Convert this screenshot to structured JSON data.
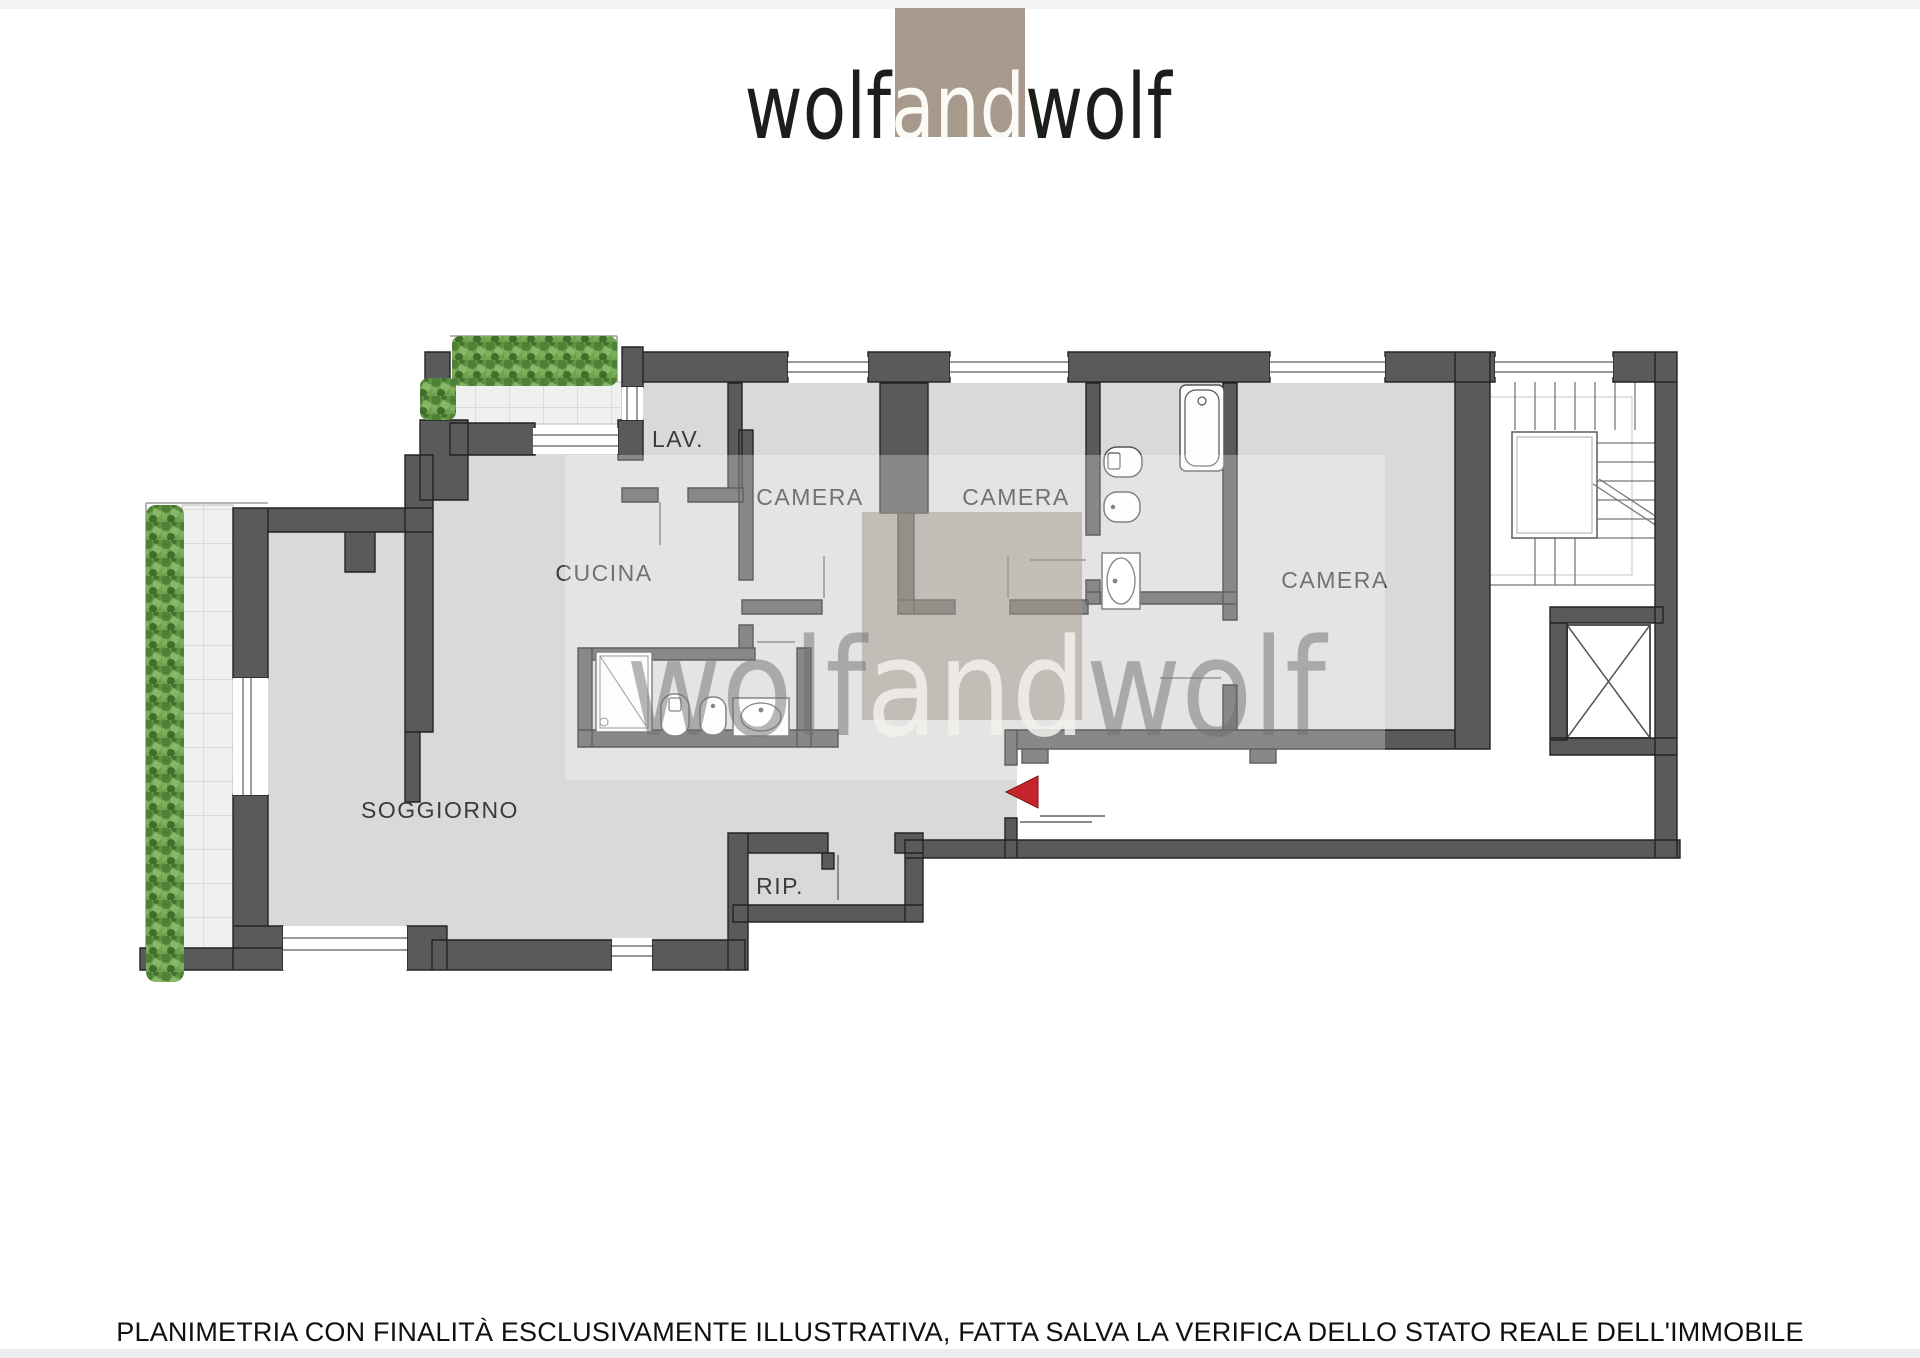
{
  "header": {
    "logo": {
      "part1": "wolf",
      "part2": "and",
      "part3": "wolf"
    }
  },
  "watermark": {
    "part1": "wolf",
    "part2": "and",
    "part3": "wolf"
  },
  "rooms": [
    {
      "id": "lav",
      "label": "LAV."
    },
    {
      "id": "camera-1",
      "label": "CAMERA"
    },
    {
      "id": "camera-2",
      "label": "CAMERA"
    },
    {
      "id": "cucina",
      "label": "CUCINA"
    },
    {
      "id": "camera-3",
      "label": "CAMERA"
    },
    {
      "id": "soggiorno",
      "label": "SOGGIORNO"
    },
    {
      "id": "rip",
      "label": "RIP."
    }
  ],
  "footer": {
    "disclaimer": "PLANIMETRIA CON FINALITÀ ESCLUSIVAMENTE ILLUSTRATIVA, FATTA SALVA LA VERIFICA DELLO STATO REALE DELL'IMMOBILE"
  },
  "colors": {
    "wall": "#595a5c",
    "floor": "#d9dad8",
    "terrace_tile": "#f0f0ee",
    "hedge_green": "#6da24f",
    "logo_tan": "#a79a8d",
    "logo_text_dark": "#1d1d1b",
    "logo_text_light": "#fbfaf5",
    "entrance_arrow_red": "#c6252b",
    "watermark_gray": "#6f6f6f"
  }
}
